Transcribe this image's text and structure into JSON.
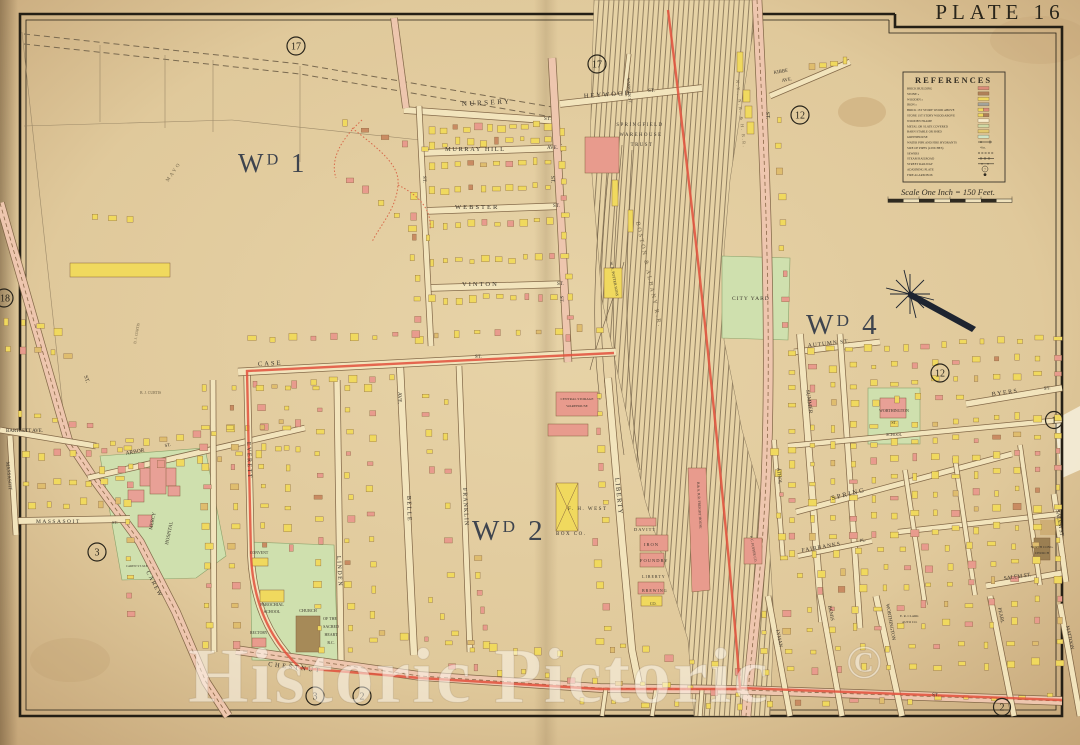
{
  "plate": {
    "label": "PLATE 16"
  },
  "legend": {
    "title": "REFERENCES",
    "items": [
      {
        "label": "BRICK BUILDING",
        "swatch": "#db8b79"
      },
      {
        "label": "STONE »",
        "swatch": "#b08058"
      },
      {
        "label": "WOODEN »",
        "swatch": "#eed75f"
      },
      {
        "label": "IRON »",
        "swatch": "#a2a39b"
      },
      {
        "label": "BRICK 1ST STORY WOOD ABOVE",
        "swatch": "#eed75f",
        "swatch2": "#db8b79"
      },
      {
        "label": "STONE 1ST STORY WOOD ABOVE",
        "swatch": "#eed75f",
        "swatch2": "#b08058"
      },
      {
        "label": "WOODEN FRAME",
        "swatch": "#f7eccb"
      },
      {
        "label": "METAL OR SLATE COVERED",
        "swatch": "#cfd9a6"
      },
      {
        "label": "BARN STABLE OR SHED",
        "swatch": "#e3c96e"
      },
      {
        "label": "GREENHOUSE",
        "swatch": "#cfe4c6"
      },
      {
        "label": "WATER PIPE AND FIRE HYDRANTS"
      },
      {
        "label": "SIZE OF PIPES (4 INCHES)"
      },
      {
        "label": "SEWERS"
      },
      {
        "label": "STEAM RAILROAD"
      },
      {
        "label": "STREET RAILWAY"
      },
      {
        "label": "ADJOINING PLATE"
      },
      {
        "label": "FIRE ALARM BOX"
      }
    ],
    "symbols": {
      "pipes": "4 in.",
      "plate_num": "7"
    },
    "scale_caption": "Scale One Inch = 150 Feet."
  },
  "wards": {
    "wd1": "Wᴰ 1",
    "wd2": "Wᴰ 2",
    "wd4": "Wᴰ 4"
  },
  "plates": {
    "p17a": "17",
    "p17b": "17",
    "p12a": "12",
    "p12b": "12",
    "p18": "18",
    "p1": "1",
    "p3a": "3",
    "p3b": "3",
    "p2a": "2",
    "p2b": "2"
  },
  "streets": {
    "nursery": "NURSERY",
    "st1": "ST.",
    "heywood": "HEYWOOD",
    "st2": "ST.",
    "murray": "MURRAY HILL",
    "ave1": "AVE.",
    "webster": "WEBSTER",
    "st3": "ST.",
    "vinton": "VINTON",
    "st4": "ST.",
    "case": "CASE",
    "st5": "ST.",
    "kibbe": "KIBBE",
    "ave2": "AVE.",
    "warwick": "WARWICK ST.",
    "st6": "ST.",
    "st7": "ST.",
    "st8": "ST.",
    "st9": "ST.",
    "st10": "ST.",
    "autumn": "AUTUMN ST.",
    "summer": "SUMMER",
    "byers": "BYERS",
    "st11": "ST.",
    "spring": "SPRING",
    "fairbanks": "FAIRBANKS",
    "pl1": "PL.",
    "salem_h": "SALEM ST.",
    "salem_v": "SALEM ST",
    "athol": "ATHOL",
    "liberty": "LIBERTY",
    "franklin": "FRANKLIN",
    "belle": "BELLE",
    "ave3": "AVE.",
    "linden": "LINDEN",
    "everett": "EVERETT",
    "carew": "CAREW",
    "chestnut": "CHESTNUT",
    "massasoit_h": "MASSASOIT",
    "st12": "ST.",
    "massasoit_v": "MASSASOIT",
    "bartlett": "BARTLETT AVE.",
    "arbor": "ARBOR",
    "st13": "ST.",
    "lyman": "LYMAN",
    "bemis": "BEMIS",
    "worthington": "WORTHINGTON",
    "pearl": "PEARL",
    "mattoon": "MATTOON",
    "st14": "ST."
  },
  "railroads": {
    "ba": "BOSTON & ALBANY R.R.",
    "nynh": "N.Y., N.H. & H. R.R.",
    "freight": "B.& A. R.R. FREIGHT HOUSE"
  },
  "places": {
    "warehouse_l1": "SPRINGFIELD",
    "warehouse_l2": "WAREHOUSE",
    "warehouse_l3": "TRUST",
    "mercy_l1": "MERCY",
    "mercy_l2": "HOSPITAL",
    "parochial_l1": "PAROCHIAL",
    "parochial_l2": "SCHOOL",
    "church_l1": "CHURCH",
    "church_l2": "OF THE",
    "church_l3": "SACRED",
    "church_l4": "HEART",
    "church_l5": "R.C.",
    "rectory": "RECTORY",
    "convent": "CONVENT",
    "carew_me": "CAREW ST. M.E.",
    "school_l1": "WORTHINGTON",
    "school_l2": "ST.",
    "school_l3": "SCHOOL",
    "westbox_l1": "F. H. WEST",
    "westbox_l2": "BOX CO.",
    "davitt": "DAVITT",
    "iron_l1": "IRON",
    "iron_l2": "FOUNDRY",
    "brew_l1": "LIBERTY",
    "brew_l2": "BREWING",
    "brew_l3": "CO.",
    "potter": "W. N. POTTER SONS",
    "puffer": "P. C. PUFFER CO.",
    "northcong_l1": "NORTH CONG.",
    "northcong_l2": "CHURCH",
    "clark_l1": "E. R. CLARK",
    "clark_l2": "AUTO CO.",
    "central_l1": "CENTRAL STORAGE",
    "central_l2": "WAREHOUSE",
    "city_yard": "CITY YARD",
    "curtis": "B. J. CURTIS",
    "mayo": "MAYO"
  },
  "watermark": {
    "text": "Historic Pictoric",
    "mark": "©"
  },
  "colors": {
    "parchment": "#e5d0a4",
    "parchment_edge": "#c9ad7f",
    "road_minor": "#f2e4bc",
    "road_artery": "#eec6ae",
    "road_casing": "#7a5f40",
    "wood": "#f0d95e",
    "brick": "#e89b8d",
    "barn": "#dfbd6e",
    "shed": "#c98b62",
    "green": "#cfe0ae",
    "boundary_red": "#e2503c",
    "rail": "#6e5c44"
  }
}
